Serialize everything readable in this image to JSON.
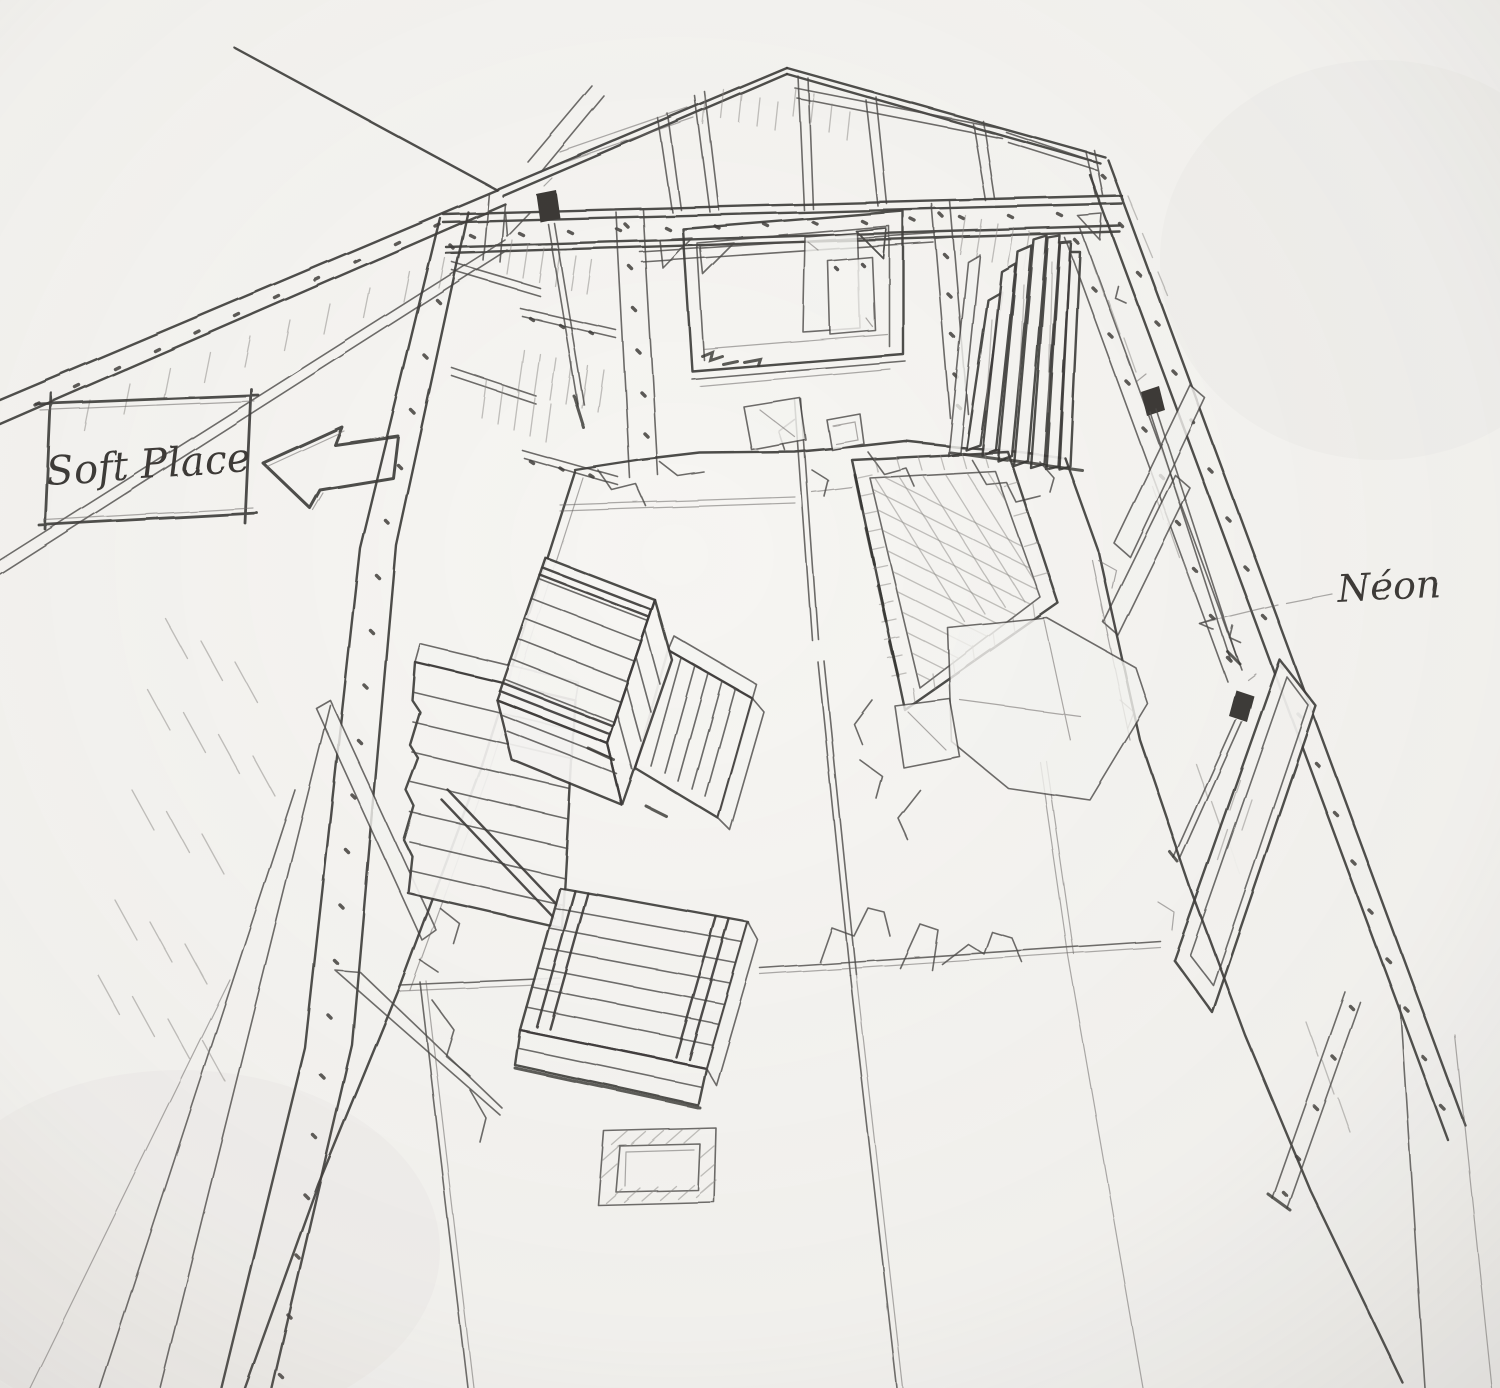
{
  "scene": {
    "medium": "pencil sketch",
    "subject": "attic storage room interior drawn in perspective",
    "paper_color": "#f6f5f2",
    "pencil_color": "#3e3c3a"
  },
  "annotations": {
    "soft_place": {
      "label": "Soft Place"
    },
    "neon": {
      "label": "Néon"
    }
  },
  "objects": {
    "crates": "wooden-slat-crates",
    "mat": "cross-hatched-mat",
    "neon_tubes": "neon-tube-lights",
    "doorway": "framed-doorway-opening",
    "floor_hatch": "floor-hatch",
    "planks": "leaning-plank-stack",
    "arrow": "hand-drawn-block-arrow"
  }
}
